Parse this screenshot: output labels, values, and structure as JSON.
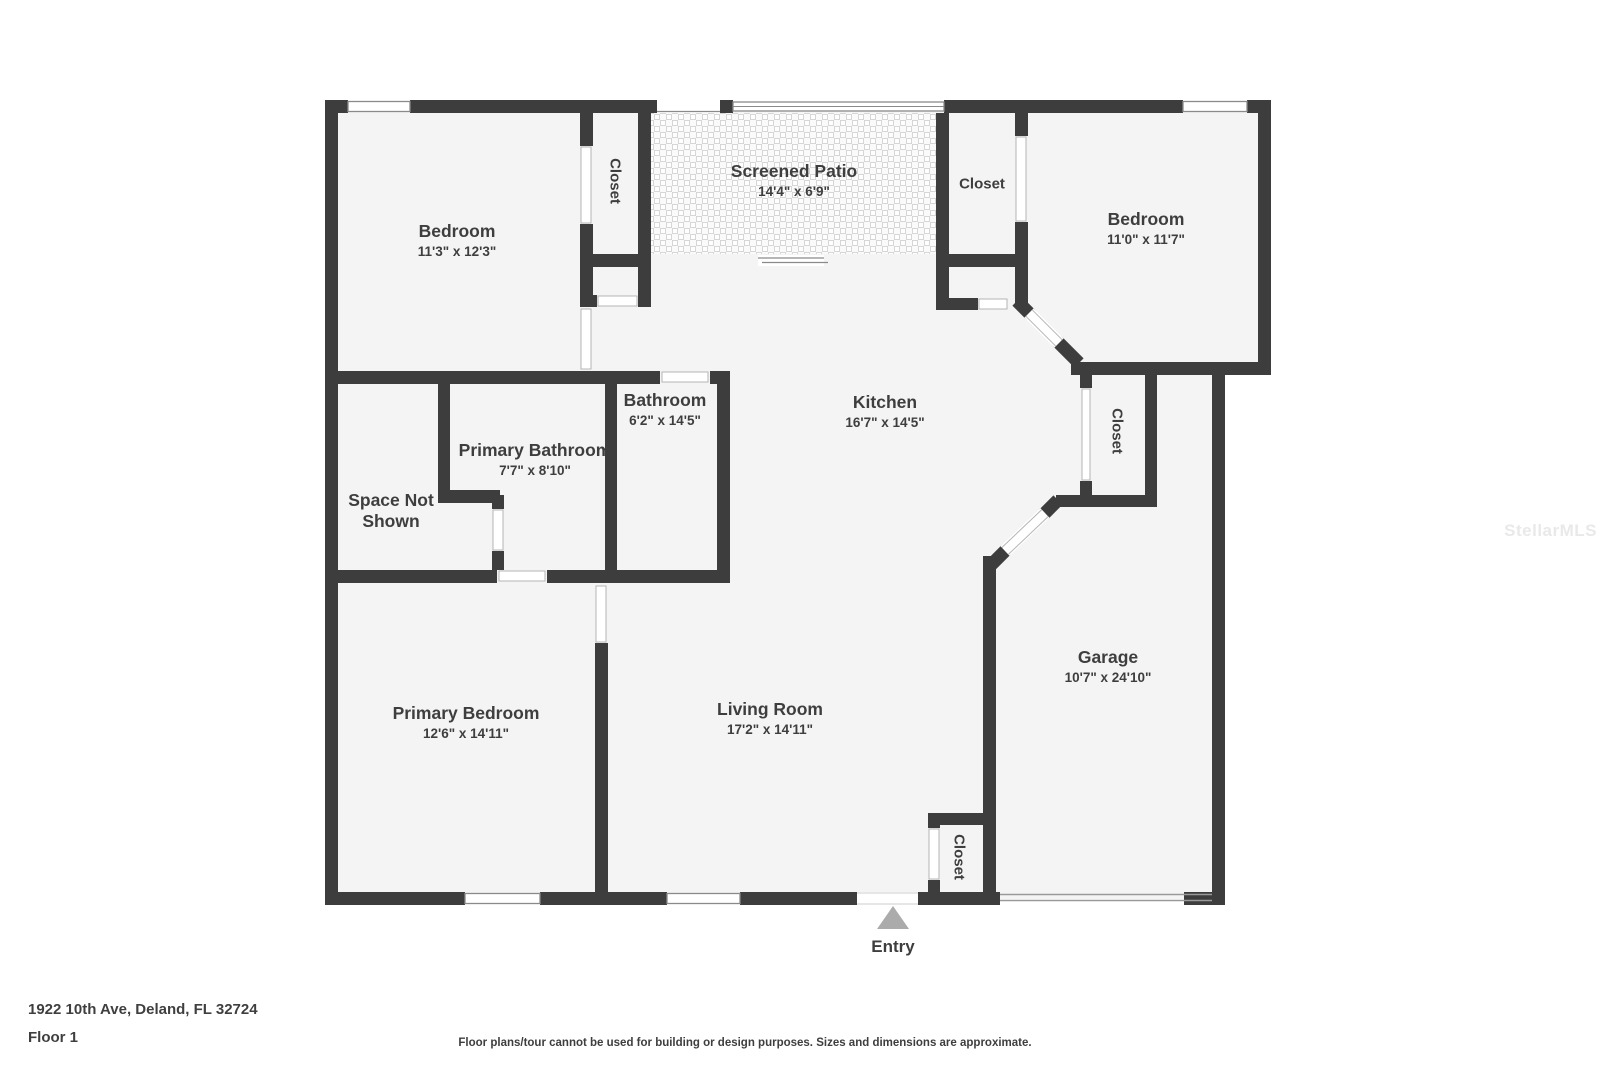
{
  "colors": {
    "wall": "#3d3d3d",
    "floor": "#f4f4f4",
    "tile_line": "#d6d6d6",
    "door_line": "#b5b5b5",
    "window_line": "#8a8a8a",
    "entry_arrow": "#ababab",
    "text": "#3e3e3e",
    "watermark": "#e9e9e9"
  },
  "rooms": [
    {
      "id": "bedroom-top-left",
      "name": "Bedroom",
      "dims": "11'3\" x 12'3\""
    },
    {
      "id": "screened-patio",
      "name": "Screened Patio",
      "dims": "14'4\" x 6'9\""
    },
    {
      "id": "bedroom-top-right",
      "name": "Bedroom",
      "dims": "11'0\" x 11'7\""
    },
    {
      "id": "bathroom",
      "name": "Bathroom",
      "dims": "6'2\" x 14'5\""
    },
    {
      "id": "primary-bathroom",
      "name": "Primary Bathroom",
      "dims": "7'7\" x 8'10\""
    },
    {
      "id": "space-not-shown",
      "name": "Space Not Shown",
      "dims": ""
    },
    {
      "id": "kitchen",
      "name": "Kitchen",
      "dims": "16'7\" x 14'5\""
    },
    {
      "id": "garage",
      "name": "Garage",
      "dims": "10'7\" x 24'10\""
    },
    {
      "id": "primary-bedroom",
      "name": "Primary Bedroom",
      "dims": "12'6\" x 14'11\""
    },
    {
      "id": "living-room",
      "name": "Living Room",
      "dims": "17'2\" x 14'11\""
    }
  ],
  "closets": [
    {
      "id": "closet-top-left",
      "label": "Closet"
    },
    {
      "id": "closet-top-right",
      "label": "Closet"
    },
    {
      "id": "closet-right-middle",
      "label": "Closet"
    },
    {
      "id": "closet-entry",
      "label": "Closet"
    }
  ],
  "entry": {
    "label": "Entry"
  },
  "footer": {
    "address": "1922 10th Ave, Deland, FL 32724",
    "floor": "Floor 1",
    "disclaimer": "Floor plans/tour cannot be used for building or design purposes. Sizes and dimensions are approximate."
  },
  "watermark": "StellarMLS"
}
